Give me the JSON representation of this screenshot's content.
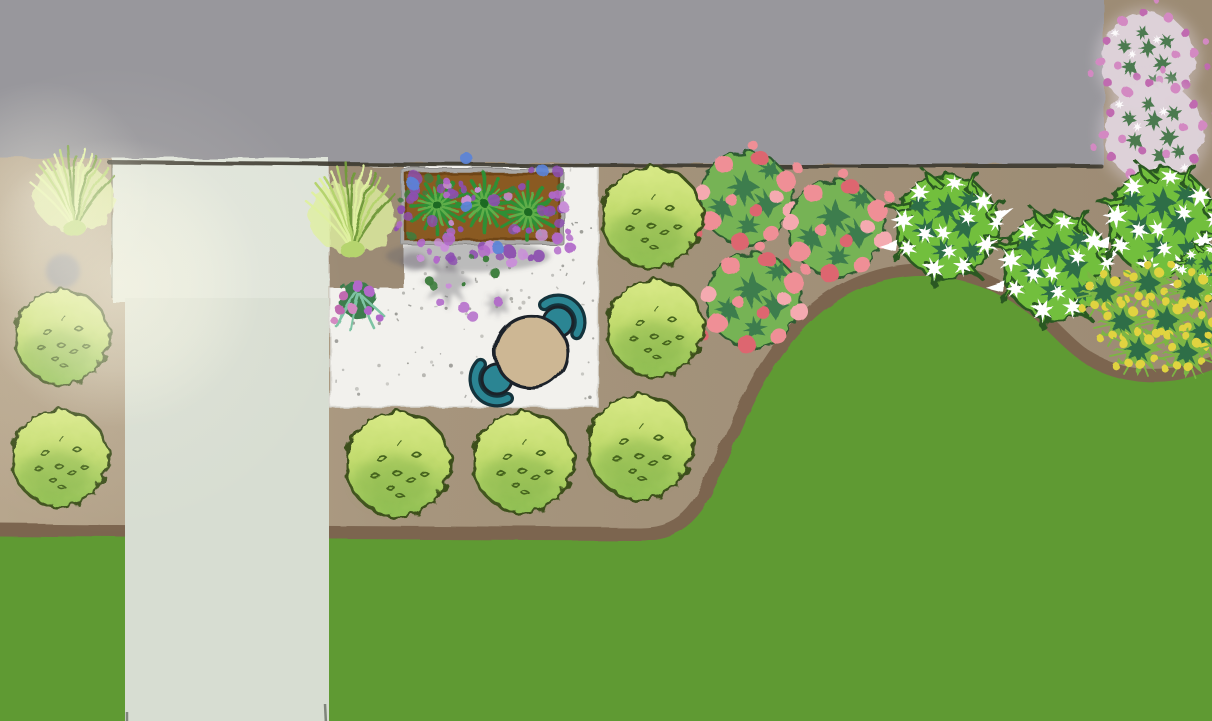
{
  "meta": {
    "title": "Garden landscape design plan (top-down illustration)",
    "width": 1212,
    "height": 721
  },
  "palette": {
    "gray_surface": "#98979c",
    "gray_edge": "#3a392f",
    "mulch_light": "#b7a68d",
    "mulch": "#a6957d",
    "mulch_dark": "#9c8b74",
    "bed_edge": "#7b654f",
    "lawn": "#5f9a33",
    "walkway": "#d7ddd2",
    "steps": "#dfe4da",
    "step_line": "#2c2f26",
    "patio": "#f2f1ed",
    "patio_speckle": "#8d8d88",
    "planter_frame": "#a9a8a6",
    "planter_soil": "#8a5a20",
    "planter_soil_edge": "#6e4517",
    "shadow": "#64616b",
    "table_top": "#cdb794",
    "outline_dark": "#1b2229",
    "chair_teal": "#2b8593",
    "chair_dark": "#14333c",
    "shrub_light": "#d8e987",
    "shrub_mid": "#c3dc6f",
    "shrub_deep": "#8fbf53",
    "shrub_shade": "#86b44b",
    "shrub_outline": "#3c501c",
    "shrub_mark": "#44631f",
    "wshrub_green": "#72bf3e",
    "wshrub_outline": "#2c5920",
    "wshrub_dark": "#2e6e46",
    "flower_white": "#ffffff",
    "pink_flower": "#ef8f96",
    "pink_flower_deep": "#dd6670",
    "pink_flower_pale": "#f4aab0",
    "pink_foliage": "#3e7d4e",
    "pink_foliage_light": "#76b355",
    "fluffy_base": "#ded3da",
    "fluffy_pink": "#d389c2",
    "fluffy_pink_deep": "#c06ab0",
    "fluffy_green": "#4c7a50",
    "purple_flower": "#b168c9",
    "purple_flower_deep": "#8d4fb0",
    "purple_flower_pale": "#c990d8",
    "blue_flower": "#5b83d8",
    "spike_plant_green": "#2f8f35",
    "spike_plant_light": "#5fae4a",
    "spike_plant_dark": "#1d6b24",
    "yellow_flower": "#e0d33f",
    "yellow_green": "#7cb544",
    "grass_light": "#dff0a0",
    "grass_mid": "#b5d46e",
    "grass_dark": "#739b3c",
    "grass_teal": "#7ec3a4",
    "glow": "#fffdeb"
  },
  "scene": {
    "description": "Top-down garden design: gray paved surface at top, mulched planting bed with shrubs and flowers, stepped walkway, white gravel patio with bistro set and raised planter, curved lawn below",
    "upper_surface": {
      "label": "gray paved surface",
      "x": 0,
      "y": 0,
      "width": 1104,
      "height": 165
    },
    "steps": {
      "label": "entry steps",
      "x": 112,
      "y": 158,
      "width": 217,
      "height": 144,
      "tread_lines_y": [
        211,
        257,
        298
      ]
    },
    "walkway": {
      "label": "walkway",
      "x": 125,
      "y": 300,
      "width": 204,
      "height": 421
    },
    "patio": {
      "label": "white gravel patio",
      "x": 330,
      "y": 166,
      "width": 268,
      "height": 241
    },
    "planter_box": {
      "label": "raised planter box with spiky plants, purple and blue flowers",
      "x": 401,
      "y": 169,
      "width": 163,
      "height": 76,
      "spike_plants": [
        [
          438,
          206
        ],
        [
          484,
          203
        ],
        [
          528,
          212
        ]
      ],
      "blue_flowers": [
        [
          467,
          159
        ],
        [
          413,
          184
        ],
        [
          466,
          206
        ],
        [
          498,
          248
        ],
        [
          543,
          171
        ]
      ],
      "purple_flower_count": 88
    },
    "table_set": {
      "label": "bistro table with two teal chairs",
      "table": {
        "cx": 531,
        "cy": 352,
        "r": 36
      },
      "chairs": [
        {
          "cx": 558,
          "cy": 322
        },
        {
          "cx": 497,
          "cy": 379
        }
      ]
    },
    "boulder": {
      "label": "gray stone",
      "cx": 63,
      "cy": 271,
      "r": 17
    },
    "light_glow": {
      "label": "sunlight glare",
      "cx": 118,
      "cy": 283,
      "r": 140
    },
    "lawn": {
      "label": "lawn"
    },
    "bed": {
      "label": "mulched planting bed"
    },
    "plants": {
      "round_shrubs": [
        [
          62,
          337,
          47
        ],
        [
          60,
          458,
          48
        ],
        [
          398,
          464,
          52
        ],
        [
          523,
          462,
          50
        ],
        [
          652,
          217,
          50
        ],
        [
          655,
          328,
          48
        ],
        [
          640,
          447,
          52
        ]
      ],
      "white_flower_shrubs": [
        [
          947,
          226,
          55
        ],
        [
          1056,
          266,
          57
        ],
        [
          1162,
          222,
          58
        ],
        [
          1206,
          273,
          30
        ]
      ],
      "pink_flower_clumps": [
        [
          746,
          198,
          55
        ],
        [
          836,
          228,
          57
        ],
        [
          753,
          300,
          56
        ]
      ],
      "fluffy_pink_clusters": [
        [
          1148,
          60,
          54
        ],
        [
          1154,
          133,
          57
        ]
      ],
      "yellow_flower_clumps": [
        [
          1104,
          292,
          26
        ],
        [
          1148,
          283,
          26
        ],
        [
          1192,
          290,
          26
        ],
        [
          1122,
          322,
          26
        ],
        [
          1166,
          320,
          27
        ],
        [
          1202,
          333,
          26
        ],
        [
          1138,
          350,
          26
        ],
        [
          1186,
          353,
          25
        ]
      ],
      "ornamental_grasses": [
        [
          74,
          206,
          52
        ],
        [
          352,
          226,
          55
        ]
      ],
      "small_pink_clusters": [
        [
          358,
          300,
          32
        ]
      ]
    },
    "speckle_count": 160
  }
}
